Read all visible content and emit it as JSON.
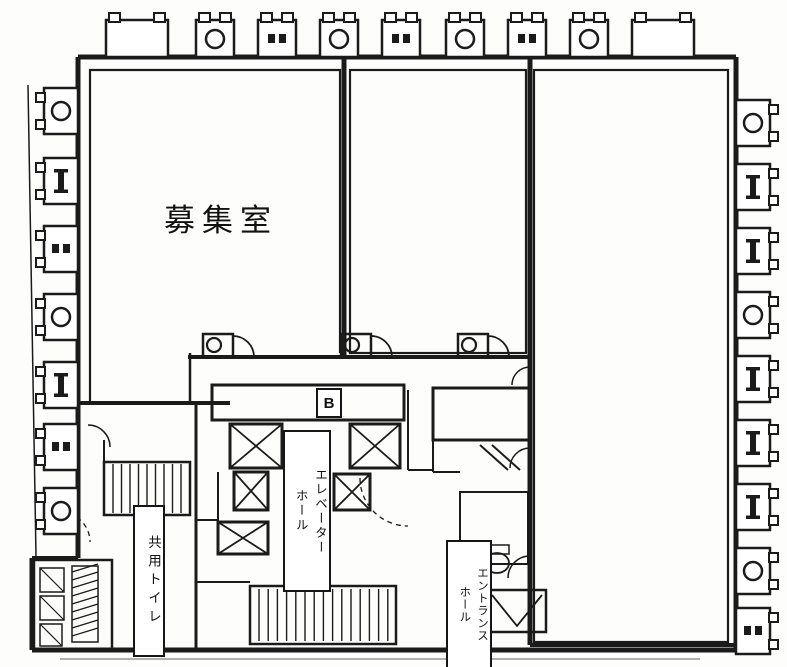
{
  "meta": {
    "type": "architectural-floor-plan",
    "language": "ja",
    "style": "black-and-white scanned blueprint"
  },
  "colors": {
    "line": "#1b1b1b",
    "background": "#fdfdfc",
    "label_background": "#ffffff"
  },
  "labels": {
    "main_room": "募集室",
    "shared_toilet": "共用トイレ",
    "elevator_hall_col1": "エレベーター",
    "elevator_hall_col2": "ホール",
    "entrance_hall_col1": "エントランス",
    "entrance_hall_col2": "ホール",
    "b_marker": "B"
  },
  "equipment_units": {
    "top": [
      {
        "x": 106,
        "w": 62,
        "type": "plain"
      },
      {
        "x": 196,
        "w": 38,
        "type": "fan"
      },
      {
        "x": 258,
        "w": 38,
        "type": "vents"
      },
      {
        "x": 320,
        "w": 38,
        "type": "fan"
      },
      {
        "x": 382,
        "w": 38,
        "type": "vents"
      },
      {
        "x": 446,
        "w": 38,
        "type": "fan"
      },
      {
        "x": 508,
        "w": 38,
        "type": "vents"
      },
      {
        "x": 570,
        "w": 38,
        "type": "fan"
      },
      {
        "x": 632,
        "w": 62,
        "type": "plain"
      }
    ],
    "left": [
      {
        "y": 88,
        "type": "fan"
      },
      {
        "y": 158,
        "type": "bar"
      },
      {
        "y": 226,
        "type": "vents"
      },
      {
        "y": 294,
        "type": "fan"
      },
      {
        "y": 362,
        "type": "bar"
      },
      {
        "y": 424,
        "type": "vents"
      },
      {
        "y": 488,
        "type": "fan"
      }
    ],
    "right": [
      {
        "y": 100,
        "type": "fan"
      },
      {
        "y": 164,
        "type": "bar"
      },
      {
        "y": 228,
        "type": "bar"
      },
      {
        "y": 292,
        "type": "fan"
      },
      {
        "y": 356,
        "type": "bar"
      },
      {
        "y": 420,
        "type": "bar"
      },
      {
        "y": 484,
        "type": "bar"
      },
      {
        "y": 548,
        "type": "fan"
      },
      {
        "y": 608,
        "type": "vents"
      }
    ]
  }
}
